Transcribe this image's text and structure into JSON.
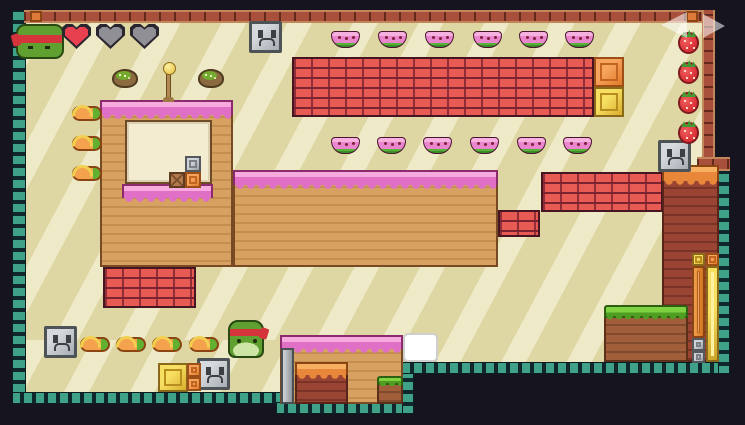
{
  "game": {
    "hud": {
      "avatar": "frog-with-red-bandana",
      "hearts": [
        "full",
        "empty",
        "empty"
      ]
    },
    "nav_arrows": [
      {
        "type": "arrow-left",
        "x": 661,
        "y": 12,
        "name": "prev-arrow",
        "interactable": "true"
      },
      {
        "type": "arrow-right",
        "x": 703,
        "y": 14,
        "name": "next-arrow",
        "interactable": "true"
      }
    ],
    "level": {
      "terrain": [
        {
          "type": "field",
          "x": 26,
          "y": 20,
          "w": 688,
          "h": 343,
          "name": "playfield-background"
        },
        {
          "type": "field",
          "x": 26,
          "y": 340,
          "w": 376,
          "h": 53,
          "name": "playfield-background"
        },
        {
          "type": "border-v",
          "x": 12,
          "y": 10,
          "w": 14,
          "h": 394,
          "name": "level-border-left"
        },
        {
          "type": "border-h",
          "x": 12,
          "y": 392,
          "w": 282,
          "h": 12,
          "name": "level-border-bottom-left"
        },
        {
          "type": "border-h",
          "x": 276,
          "y": 402,
          "w": 138,
          "h": 12,
          "name": "level-border-under-structure"
        },
        {
          "type": "border-v",
          "x": 402,
          "y": 362,
          "w": 12,
          "h": 52,
          "name": "level-border-step"
        },
        {
          "type": "border-h",
          "x": 402,
          "y": 362,
          "w": 328,
          "h": 12,
          "name": "level-border-bottom-right"
        },
        {
          "type": "border-v",
          "x": 718,
          "y": 158,
          "w": 12,
          "h": 216,
          "name": "level-border-right"
        },
        {
          "type": "bar-brick-h",
          "x": 24,
          "y": 10,
          "w": 690,
          "h": 13,
          "name": "top-brick-rail"
        },
        {
          "type": "bar-brick-v",
          "x": 702,
          "y": 10,
          "w": 13,
          "h": 150,
          "name": "right-brick-rail"
        },
        {
          "type": "bar-brick-h",
          "x": 697,
          "y": 157,
          "w": 33,
          "h": 14,
          "name": "right-brick-joint"
        },
        {
          "type": "tan",
          "x": 233,
          "y": 170,
          "w": 265,
          "h": 97,
          "name": "terrain-wide-block"
        },
        {
          "type": "frost-pink",
          "x": 233,
          "y": 170,
          "w": 265,
          "h": 15,
          "name": "pink-frosting-top"
        },
        {
          "type": "tan",
          "x": 100,
          "y": 100,
          "w": 133,
          "h": 167,
          "name": "terrain-left-tower"
        },
        {
          "type": "frost-pink",
          "x": 100,
          "y": 100,
          "w": 133,
          "h": 15,
          "name": "pink-frosting-top"
        },
        {
          "type": "window",
          "x": 125,
          "y": 120,
          "w": 87,
          "h": 64,
          "name": "terrain-window"
        },
        {
          "type": "frost-pink",
          "x": 122,
          "y": 184,
          "w": 91,
          "h": 14,
          "name": "window-sill-frosting"
        },
        {
          "type": "brick",
          "x": 292,
          "y": 57,
          "w": 302,
          "h": 60,
          "name": "brick-platform-top"
        },
        {
          "type": "brick",
          "x": 541,
          "y": 172,
          "w": 122,
          "h": 40,
          "name": "brick-platform-mid"
        },
        {
          "type": "brick",
          "x": 498,
          "y": 210,
          "w": 42,
          "h": 27,
          "name": "brick-block-small"
        },
        {
          "type": "brick",
          "x": 103,
          "y": 267,
          "w": 93,
          "h": 41,
          "name": "brick-platform-bottom-left"
        },
        {
          "type": "brown",
          "x": 662,
          "y": 180,
          "w": 57,
          "h": 182,
          "name": "terrain-right-column"
        },
        {
          "type": "frost-orange",
          "x": 662,
          "y": 165,
          "w": 57,
          "h": 16,
          "name": "orange-frosting-top"
        },
        {
          "type": "dirt",
          "x": 604,
          "y": 317,
          "w": 84,
          "h": 45,
          "name": "grass-platform-dirt"
        },
        {
          "type": "grass",
          "x": 604,
          "y": 305,
          "w": 84,
          "h": 13,
          "name": "grass-platform-top"
        },
        {
          "type": "tan",
          "x": 280,
          "y": 336,
          "w": 123,
          "h": 68,
          "name": "bottom-structure-body"
        },
        {
          "type": "frost-pink",
          "x": 280,
          "y": 335,
          "w": 123,
          "h": 14,
          "name": "bottom-structure-frosting"
        },
        {
          "type": "brown",
          "x": 295,
          "y": 374,
          "w": 53,
          "h": 30,
          "name": "bottom-structure-inner-block"
        },
        {
          "type": "frost-orange",
          "x": 295,
          "y": 362,
          "w": 53,
          "h": 13,
          "name": "bottom-structure-inner-frosting"
        },
        {
          "type": "dirt",
          "x": 377,
          "y": 384,
          "w": 26,
          "h": 20,
          "name": "bottom-structure-grass-dirt"
        },
        {
          "type": "grass",
          "x": 377,
          "y": 376,
          "w": 26,
          "h": 9,
          "name": "bottom-structure-grass-top"
        },
        {
          "type": "gray-pillar",
          "x": 281,
          "y": 348,
          "w": 13,
          "h": 56,
          "name": "metal-pillar"
        }
      ],
      "objects": [
        {
          "type": "face-box",
          "x": 249,
          "y": 21,
          "w": 33,
          "h": 32,
          "name": "stone-face-block"
        },
        {
          "type": "face-box",
          "x": 658,
          "y": 140,
          "w": 33,
          "h": 32,
          "name": "stone-face-block"
        },
        {
          "type": "face-box",
          "x": 44,
          "y": 326,
          "w": 33,
          "h": 32,
          "name": "stone-face-block"
        },
        {
          "type": "face-box",
          "x": 197,
          "y": 358,
          "w": 33,
          "h": 32,
          "name": "stone-face-block"
        },
        {
          "type": "orange-box",
          "x": 594,
          "y": 57,
          "w": 30,
          "h": 30,
          "name": "orange-item-box"
        },
        {
          "type": "gold-box",
          "x": 594,
          "y": 87,
          "w": 30,
          "h": 30,
          "name": "gold-item-box"
        },
        {
          "type": "gold-box",
          "x": 158,
          "y": 363,
          "w": 30,
          "h": 29,
          "name": "gold-item-box"
        },
        {
          "type": "orange-box",
          "x": 187,
          "y": 363,
          "w": 14,
          "h": 14,
          "name": "orange-item-box"
        },
        {
          "type": "orange-box",
          "x": 187,
          "y": 377,
          "w": 14,
          "h": 14,
          "name": "orange-item-box"
        },
        {
          "type": "gold-box",
          "x": 692,
          "y": 253,
          "w": 13,
          "h": 13,
          "name": "gold-item-box"
        },
        {
          "type": "orange-box",
          "x": 706,
          "y": 253,
          "w": 13,
          "h": 13,
          "name": "orange-item-box"
        },
        {
          "type": "orange-bar",
          "x": 692,
          "y": 266,
          "w": 13,
          "h": 72,
          "name": "orange-pillar"
        },
        {
          "type": "gold-pillar",
          "x": 706,
          "y": 266,
          "w": 13,
          "h": 96,
          "name": "gold-pillar"
        },
        {
          "type": "gray-box",
          "x": 692,
          "y": 338,
          "w": 13,
          "h": 13,
          "name": "metal-box"
        },
        {
          "type": "gray-box",
          "x": 692,
          "y": 351,
          "w": 13,
          "h": 12,
          "name": "metal-box"
        },
        {
          "type": "gray-box",
          "x": 185,
          "y": 156,
          "w": 16,
          "h": 16,
          "name": "metal-box"
        },
        {
          "type": "brown-box",
          "x": 169,
          "y": 172,
          "w": 16,
          "h": 16,
          "name": "wood-crate"
        },
        {
          "type": "orange-box",
          "x": 185,
          "y": 172,
          "w": 16,
          "h": 16,
          "name": "orange-item-box"
        },
        {
          "type": "pole",
          "x": 166,
          "y": 71,
          "w": 5,
          "h": 31,
          "name": "checkpoint-pole"
        },
        {
          "type": "orange-cap",
          "x": 30,
          "y": 11,
          "w": 12,
          "h": 11,
          "name": "rail-end-cap"
        },
        {
          "type": "orange-cap",
          "x": 686,
          "y": 11,
          "w": 12,
          "h": 11,
          "name": "rail-end-cap"
        },
        {
          "type": "dialog",
          "x": 403,
          "y": 333,
          "w": 35,
          "h": 29,
          "name": "speech-bubble"
        }
      ],
      "collectibles": [
        {
          "type": "melon",
          "x": 112,
          "y": 69,
          "name": "melon-item"
        },
        {
          "type": "melon",
          "x": 198,
          "y": 69,
          "name": "melon-item"
        },
        {
          "type": "watermelon",
          "x": 331,
          "y": 31,
          "name": "watermelon-item"
        },
        {
          "type": "watermelon",
          "x": 378,
          "y": 31,
          "name": "watermelon-item"
        },
        {
          "type": "watermelon",
          "x": 425,
          "y": 31,
          "name": "watermelon-item"
        },
        {
          "type": "watermelon",
          "x": 473,
          "y": 31,
          "name": "watermelon-item"
        },
        {
          "type": "watermelon",
          "x": 519,
          "y": 31,
          "name": "watermelon-item"
        },
        {
          "type": "watermelon",
          "x": 565,
          "y": 31,
          "name": "watermelon-item"
        },
        {
          "type": "watermelon",
          "x": 331,
          "y": 137,
          "name": "watermelon-item"
        },
        {
          "type": "watermelon",
          "x": 377,
          "y": 137,
          "name": "watermelon-item"
        },
        {
          "type": "watermelon",
          "x": 423,
          "y": 137,
          "name": "watermelon-item"
        },
        {
          "type": "watermelon",
          "x": 470,
          "y": 137,
          "name": "watermelon-item"
        },
        {
          "type": "watermelon",
          "x": 517,
          "y": 137,
          "name": "watermelon-item"
        },
        {
          "type": "watermelon",
          "x": 563,
          "y": 137,
          "name": "watermelon-item"
        },
        {
          "type": "strawberry",
          "x": 678,
          "y": 32,
          "name": "strawberry-item"
        },
        {
          "type": "strawberry",
          "x": 678,
          "y": 62,
          "name": "strawberry-item"
        },
        {
          "type": "strawberry",
          "x": 678,
          "y": 92,
          "name": "strawberry-item"
        },
        {
          "type": "strawberry",
          "x": 678,
          "y": 122,
          "name": "strawberry-item"
        },
        {
          "type": "carrot",
          "x": 72,
          "y": 106,
          "name": "carrot-item"
        },
        {
          "type": "carrot",
          "x": 72,
          "y": 136,
          "name": "carrot-item"
        },
        {
          "type": "carrot",
          "x": 72,
          "y": 166,
          "name": "carrot-item"
        },
        {
          "type": "carrot",
          "x": 80,
          "y": 337,
          "name": "carrot-item"
        },
        {
          "type": "carrot",
          "x": 116,
          "y": 337,
          "name": "carrot-item"
        },
        {
          "type": "carrot",
          "x": 152,
          "y": 337,
          "name": "carrot-item"
        },
        {
          "type": "carrot",
          "x": 189,
          "y": 337,
          "name": "carrot-item"
        }
      ],
      "characters": [
        {
          "type": "player",
          "x": 228,
          "y": 320,
          "name": "player-frog"
        }
      ]
    },
    "palette": {
      "background_outer": "#16141f",
      "field": "#ded7a4",
      "border_teal": "#3fa187",
      "brick_red": "#e85b54",
      "brick_dark": "#a8503c",
      "frosting_pink": "#e070c6",
      "frosting_orange": "#e8873a",
      "terrain_tan": "#d7a161",
      "terrain_brown": "#9a4434",
      "grass_green": "#7ed23f",
      "gold": "#e9c63c",
      "heart_full": "#e8404e",
      "heart_empty": "#8f8f95"
    }
  }
}
